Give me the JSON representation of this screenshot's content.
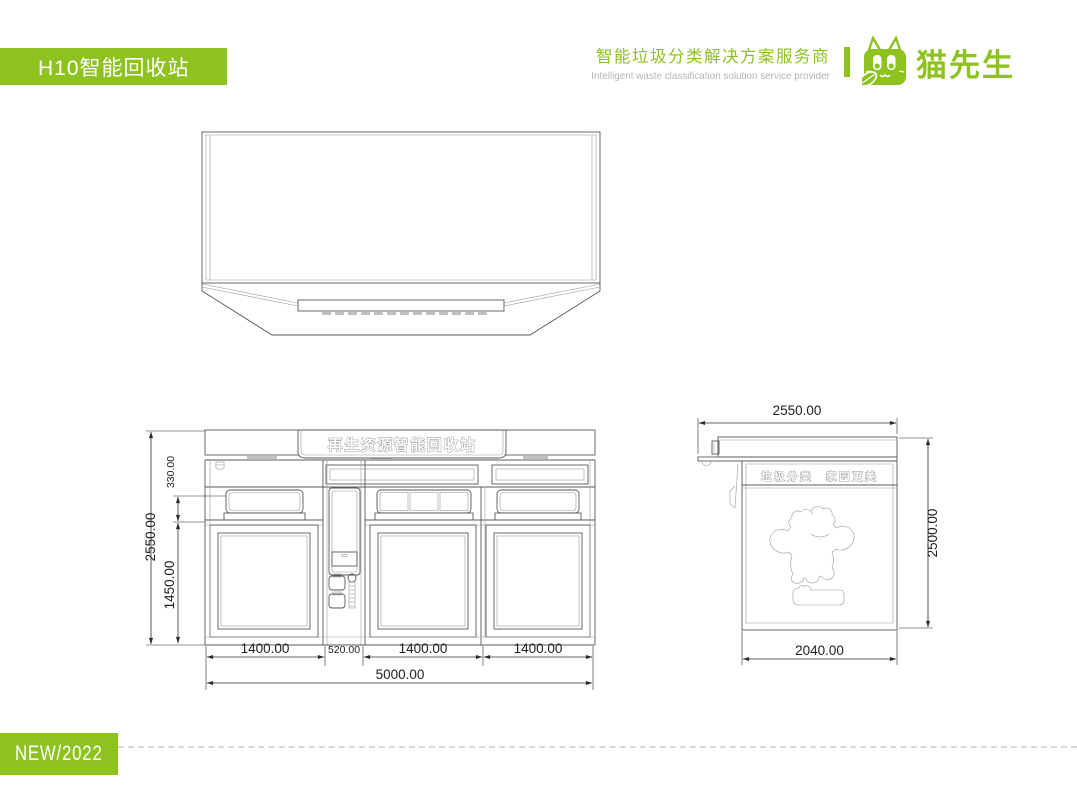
{
  "header": {
    "model_title": "H10智能回收站",
    "tagline_cn": "智能垃圾分类解决方案服务商",
    "tagline_en": "Intelligent waste classification solution service provider",
    "brand_name": "猫先生"
  },
  "front_view": {
    "sign_text": "再生资源智能回收站",
    "dims": {
      "overall_height": "2550.00",
      "hopper_height": "330.00",
      "door_height": "1450.00",
      "widths": [
        "1400.00",
        "520.00",
        "1400.00",
        "1400.00"
      ],
      "overall_width": "5000.00"
    }
  },
  "side_view": {
    "band_text": "垃圾分类　家园更美",
    "dims": {
      "roof_depth": "2550.00",
      "overall_height": "2500.00",
      "body_depth": "2040.00"
    }
  },
  "badge": {
    "label": "NEW/2022"
  },
  "colors": {
    "brand_green": "#8dc21f",
    "drawing_line": "#5a5a5a",
    "dim_text": "#1e1e1e",
    "tagline_en_gray": "#b5b5b5",
    "dashed_rule": "#d8d8d8"
  }
}
